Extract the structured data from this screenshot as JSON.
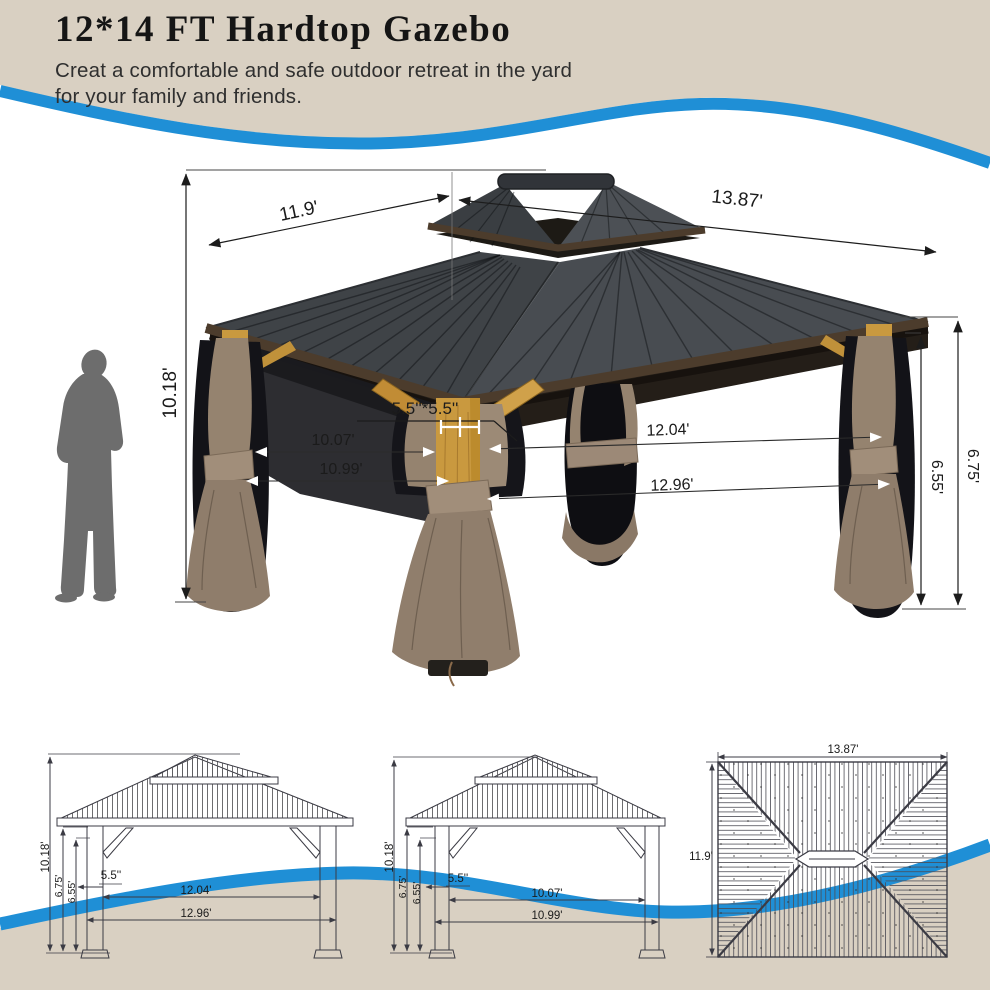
{
  "header": {
    "title": "12*14 FT Hardtop Gazebo",
    "subtitle_line1": "Creat a comfortable and safe outdoor retreat in the yard",
    "subtitle_line2": "for your family and friends."
  },
  "palette": {
    "beige": "#d9d0c2",
    "wave_blue": "#1f8fd6",
    "silhouette_gray": "#6d6d6d",
    "roof_dark": "#43474c",
    "wood": "#c9993f",
    "curtain_taupe": "#93816f",
    "mesh_black": "#131318"
  },
  "main_view": {
    "dim_roof_left": "11.9'",
    "dim_roof_right": "13.87'",
    "dim_total_height": "10.18'",
    "dim_post_section": "5.5''*5.5''",
    "dim_inner_depth": "10.07'",
    "dim_outer_depth": "10.99'",
    "dim_inner_width": "12.04'",
    "dim_outer_width": "12.96'",
    "dim_inner_height": "6.55'",
    "dim_eave_height": "6.75'"
  },
  "front_view": {
    "dim_total_height": "10.18'",
    "dim_eave_height": "6.75'",
    "dim_inner_height": "6.55'",
    "dim_post": "5.5''",
    "dim_inner_width": "12.04'",
    "dim_outer_width": "12.96'"
  },
  "side_view": {
    "dim_total_height": "10.18'",
    "dim_eave_height": "6.75'",
    "dim_inner_height": "6.55'",
    "dim_post": "5.5''",
    "dim_inner_depth": "10.07'",
    "dim_outer_depth": "10.99'"
  },
  "top_view": {
    "dim_width": "13.87'",
    "dim_depth": "11.9'"
  }
}
